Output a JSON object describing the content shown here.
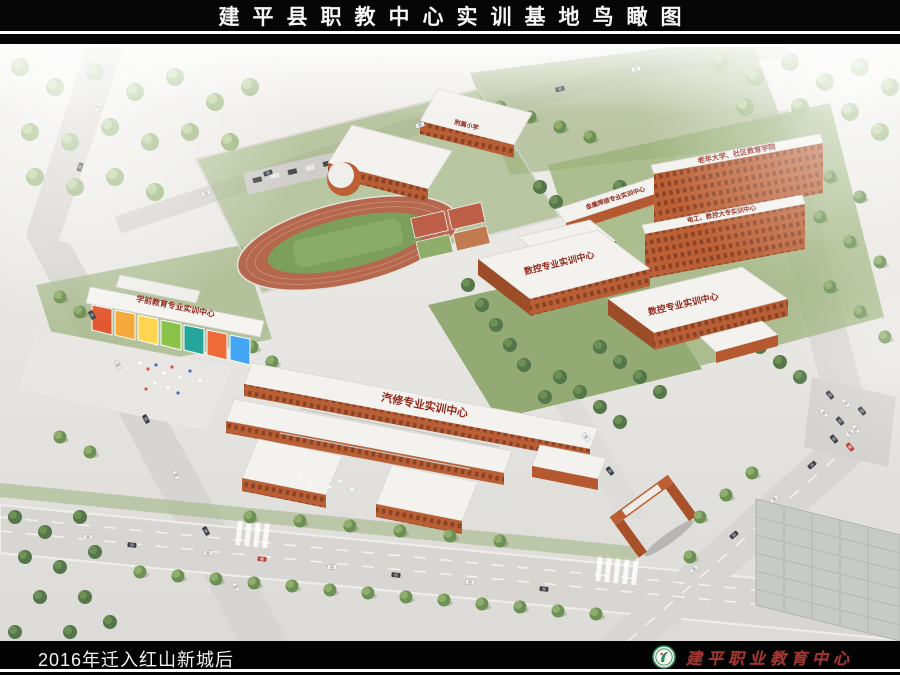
{
  "header": {
    "title": "建平县职教中心实训基地鸟瞰图"
  },
  "scene": {
    "type": "architectural-aerial-rendering",
    "subject": "campus bird's-eye view with labeled training buildings, running track, roads and trees",
    "building_labels": {
      "affiliated_primary_school": "附属小学",
      "welding_center": "金属焊接专业实训中心",
      "senior_university": "老年大学、社区教育学院",
      "electrical_cnc_college": "电工、数控大专实训中心",
      "cnc_center_north": "数控专业实训中心",
      "cnc_center_south": "数控专业实训中心",
      "preschool_center": "学前教育专业实训中心",
      "auto_repair_center": "汽修专业实训中心"
    },
    "colors": {
      "brick_wall": "#bc6136",
      "roof_white": "#f3f2ee",
      "label_red": "#93291e",
      "grass_green": "#93aa74",
      "track_red": "#b5684e",
      "asphalt": "#d8d6d2",
      "tree_green": "#6d9055"
    }
  },
  "footer": {
    "caption": "2016年迁入红山新城后",
    "logo_icon": "school-emblem",
    "logo_text": "建平职业教育中心"
  }
}
